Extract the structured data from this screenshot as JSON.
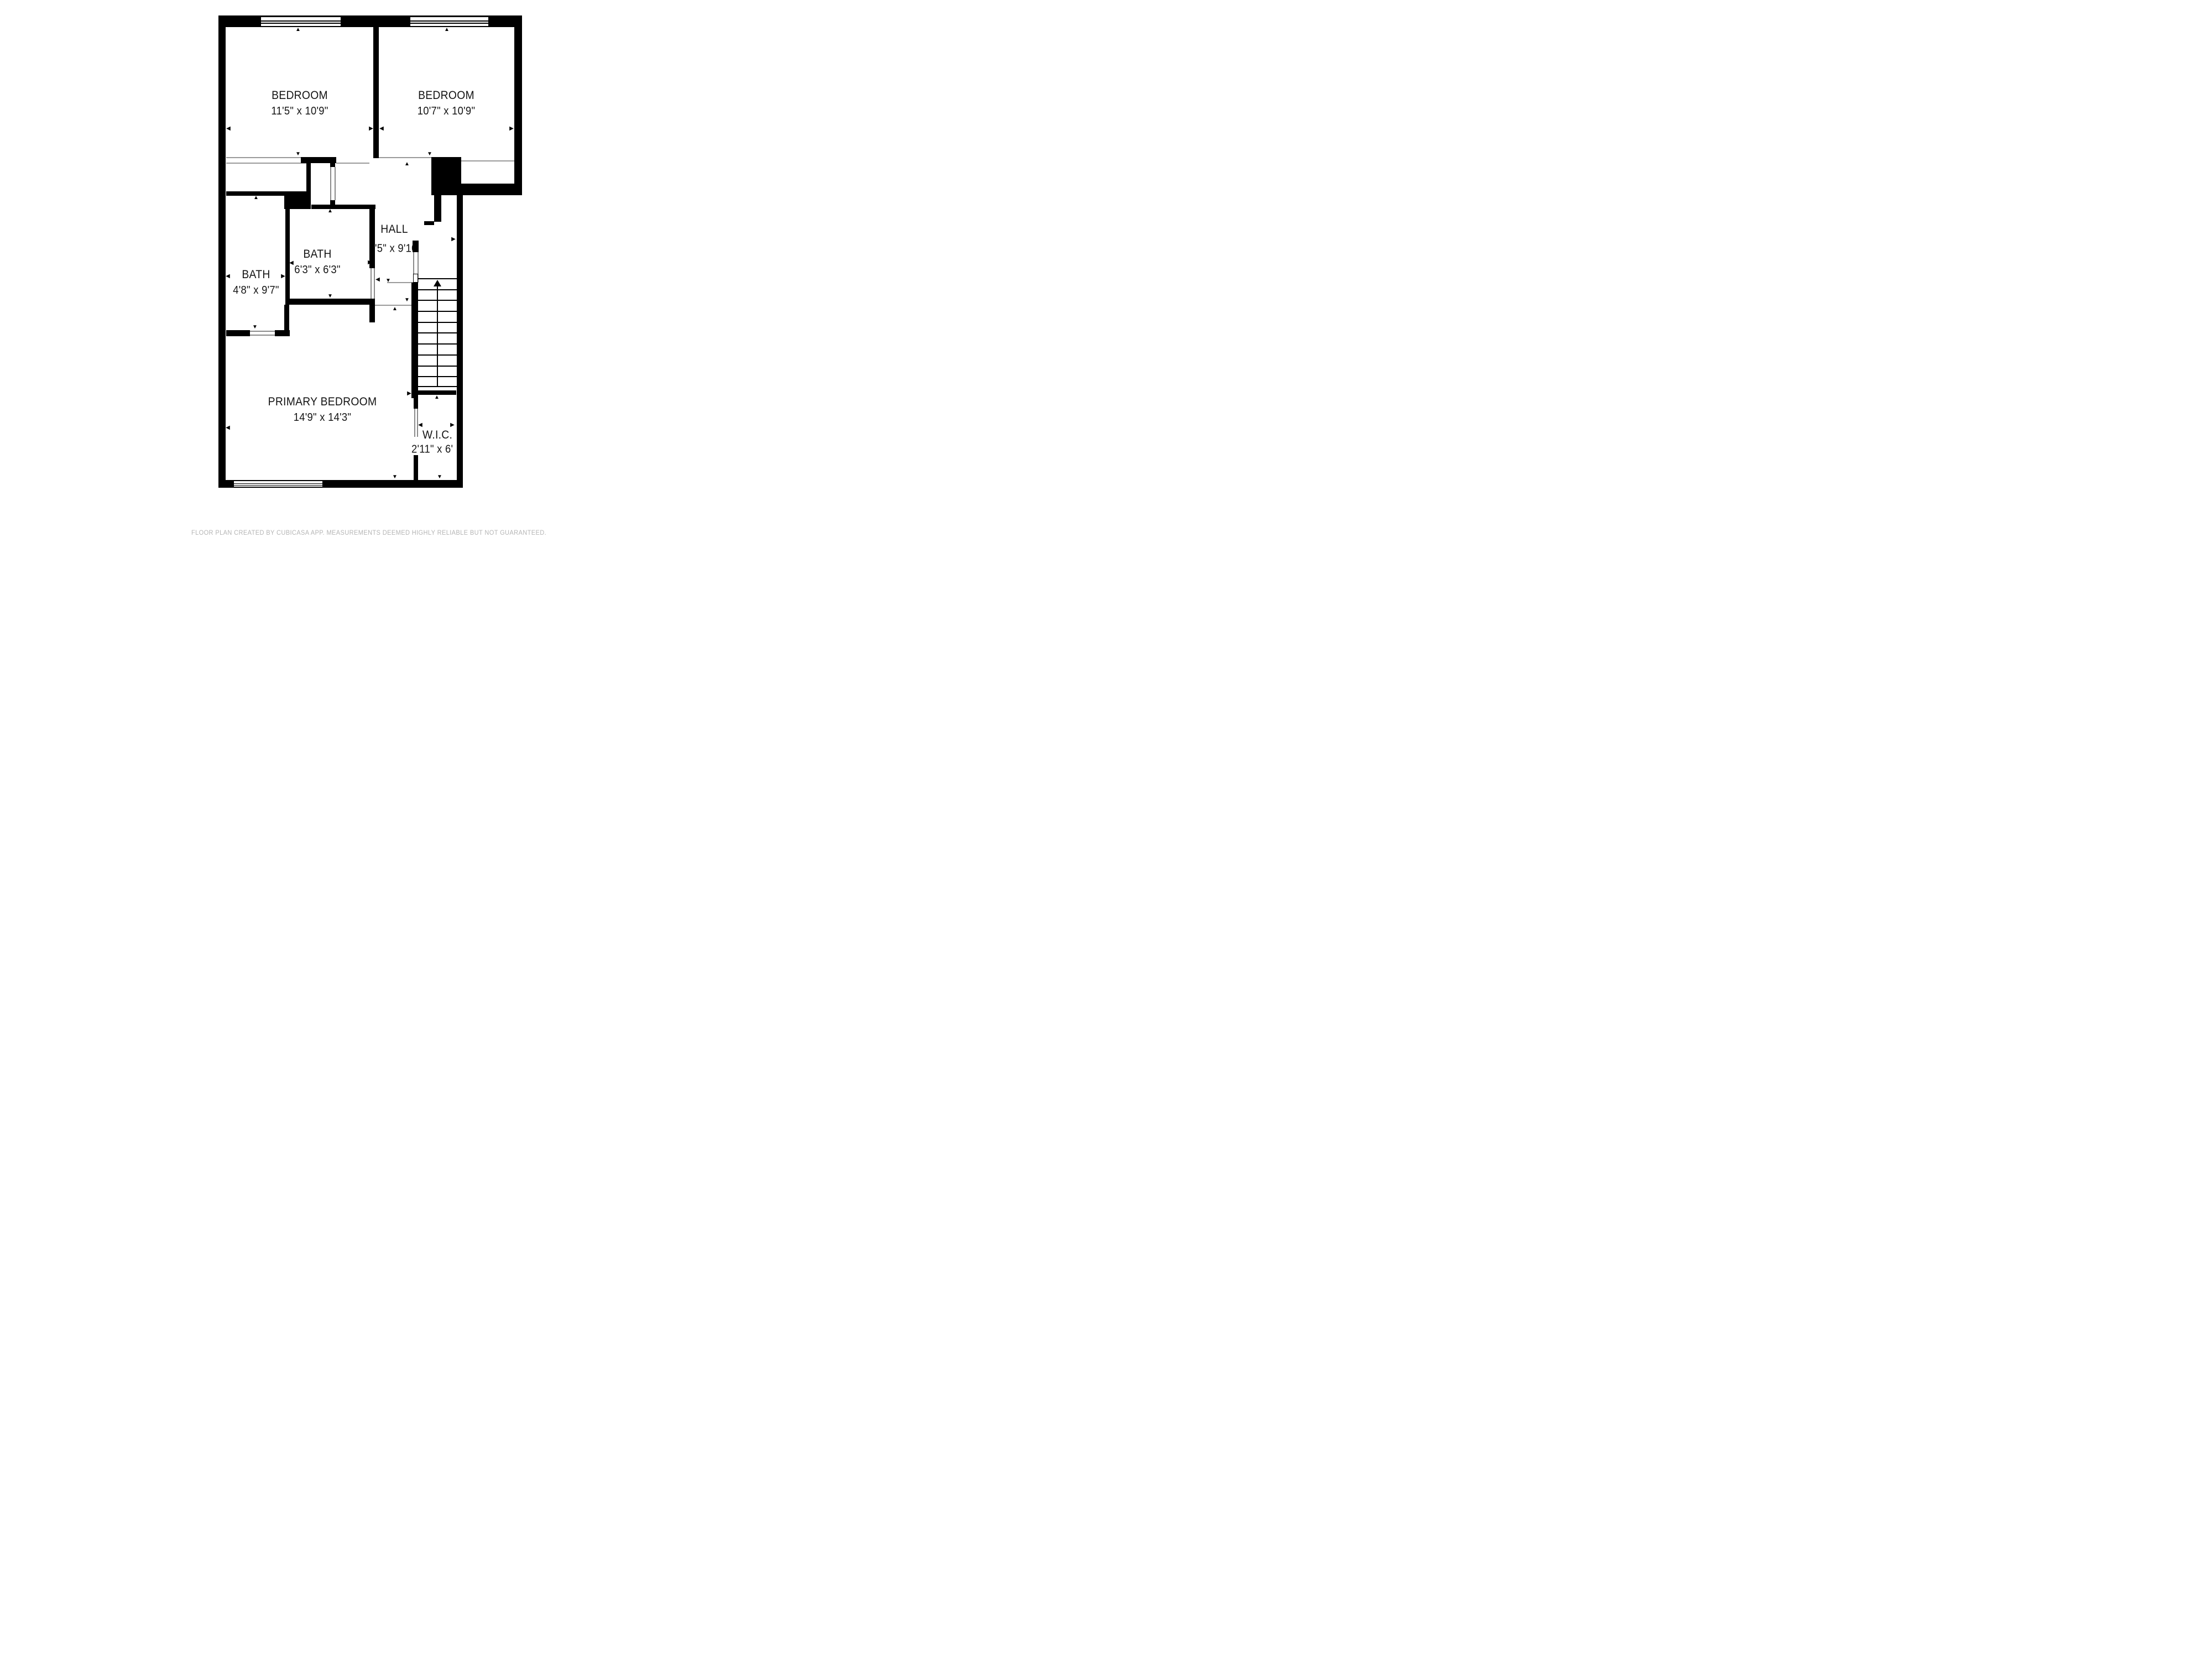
{
  "title": "Second floor plan",
  "rooms": {
    "bedroom1": {
      "name": "BEDROOM",
      "dims": "11'5\" x 10'9\""
    },
    "bedroom2": {
      "name": "BEDROOM",
      "dims": "10'7\" x 10'9\""
    },
    "hall": {
      "name": "HALL",
      "dims": "'5\" x 9'10"
    },
    "bath_center": {
      "name": "BATH",
      "dims": "6'3\" x 6'3\""
    },
    "bath_left": {
      "name": "BATH",
      "dims": "4'8\" x 9'7\""
    },
    "primary": {
      "name": "PRIMARY BEDROOM",
      "dims": "14'9\" x 14'3\""
    },
    "wic": {
      "name": "W.I.C.",
      "dims": "2'11\" x 6'"
    }
  },
  "icons": {
    "up": "▲",
    "down": "▼",
    "left": "◀",
    "right": "▶"
  },
  "footer": {
    "text": "FLOOR PLAN CREATED BY CUBICASA APP. MEASUREMENTS DEEMED HIGHLY RELIABLE BUT NOT GUARANTEED."
  },
  "colors": {
    "wall": "#000000",
    "open_boundary_line": "#9a9a9a",
    "label_text": "#141414",
    "footer_text": "#b5b5b5",
    "background": "#ffffff"
  }
}
